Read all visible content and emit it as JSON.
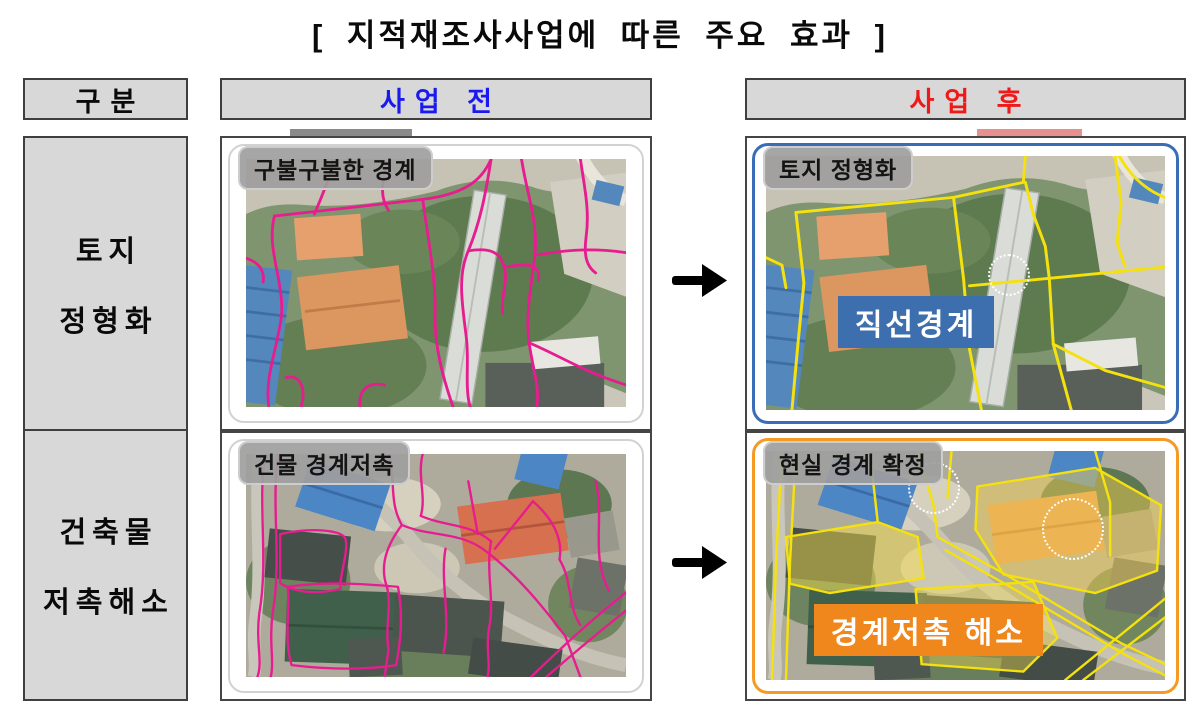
{
  "title": "[ 지적재조사사업에  따른  주요  효과 ]",
  "table": {
    "headers": {
      "category": "구분",
      "before": "사업 전",
      "after": "사업 후"
    },
    "rows": [
      {
        "category_line1": "토지",
        "category_line2": "정형화",
        "before_label": "구불구불한 경계",
        "after_label": "토지 정형화",
        "after_badge": "직선경계",
        "arrow": "→"
      },
      {
        "category_line1": "건축물",
        "category_line2": "저촉해소",
        "before_label": "건물 경계저촉",
        "after_label": "현실 경계 확정",
        "after_badge": "경계저촉 해소",
        "arrow": "→"
      }
    ]
  },
  "icons": {
    "transform_arrow": "right-arrow-icon"
  },
  "colors": {
    "header_before_text": "#1a1aee",
    "header_after_text": "#ee1a1a",
    "cell_bg": "#d8d8d8",
    "before_boundary_line": "#e71c8f",
    "after_boundary_line": "#f4e10d",
    "after_frame_row1": "#3a6db8",
    "after_frame_row2": "#f59b24",
    "badge_row1_bg": "#3d6eae",
    "badge_row2_bg": "#f0871c"
  }
}
